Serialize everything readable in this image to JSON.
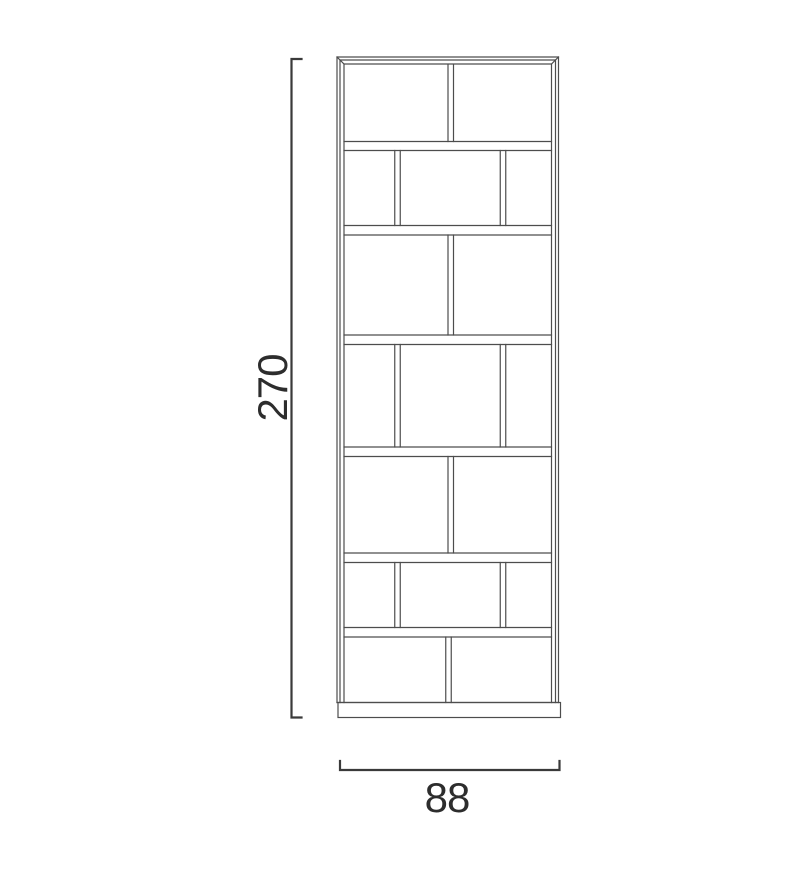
{
  "diagram": {
    "type": "furniture-dimension-drawing",
    "subject": "tall bookshelf / shelving unit front elevation",
    "height_label": "270",
    "width_label": "88"
  },
  "colors": {
    "background": "#ffffff",
    "furniture_line": "#4d4d4d",
    "dimension_line": "#3a3a3a",
    "label_text": "#2d2d2d"
  },
  "geometry": {
    "canvas": {
      "width": 811,
      "height": 869
    },
    "frame": {
      "x1": 337,
      "y1": 57,
      "x2": 558.5,
      "y2": 702.5,
      "inset_mid": 3,
      "inset_inner": 7
    },
    "bands": [
      [
        141.5,
        150.5
      ],
      [
        225.5,
        235
      ],
      [
        335,
        344.5
      ],
      [
        447,
        456.5
      ],
      [
        553,
        562.5
      ],
      [
        627.5,
        637
      ]
    ],
    "rows": [
      {
        "top": 64.5,
        "bottom": 141.5,
        "dividers": [
          450.75
        ]
      },
      {
        "top": 150.5,
        "bottom": 225.5,
        "dividers": [
          397.5,
          503
        ]
      },
      {
        "top": 235,
        "bottom": 335,
        "dividers": [
          450.75
        ]
      },
      {
        "top": 344.5,
        "bottom": 447,
        "dividers": [
          397.5,
          503
        ]
      },
      {
        "top": 456.5,
        "bottom": 553,
        "dividers": [
          450.75
        ]
      },
      {
        "top": 562.5,
        "bottom": 627.5,
        "dividers": [
          397.5,
          503
        ]
      },
      {
        "top": 637,
        "bottom": 702.5,
        "dividers": [
          448.5
        ]
      }
    ],
    "divider_halfgap": 2.75,
    "plinth": {
      "x1": 338,
      "y1": 702.5,
      "x2": 560.5,
      "y2": 717.5
    },
    "dim_vertical": {
      "x": 291.5,
      "y1": 59,
      "y2": 717.5,
      "tick": 10,
      "label_x": 287,
      "label_y": 388
    },
    "dim_horizontal": {
      "y": 770,
      "x1": 340,
      "x2": 559.5,
      "tick": 9,
      "label_x": 447,
      "label_y": 812
    }
  }
}
